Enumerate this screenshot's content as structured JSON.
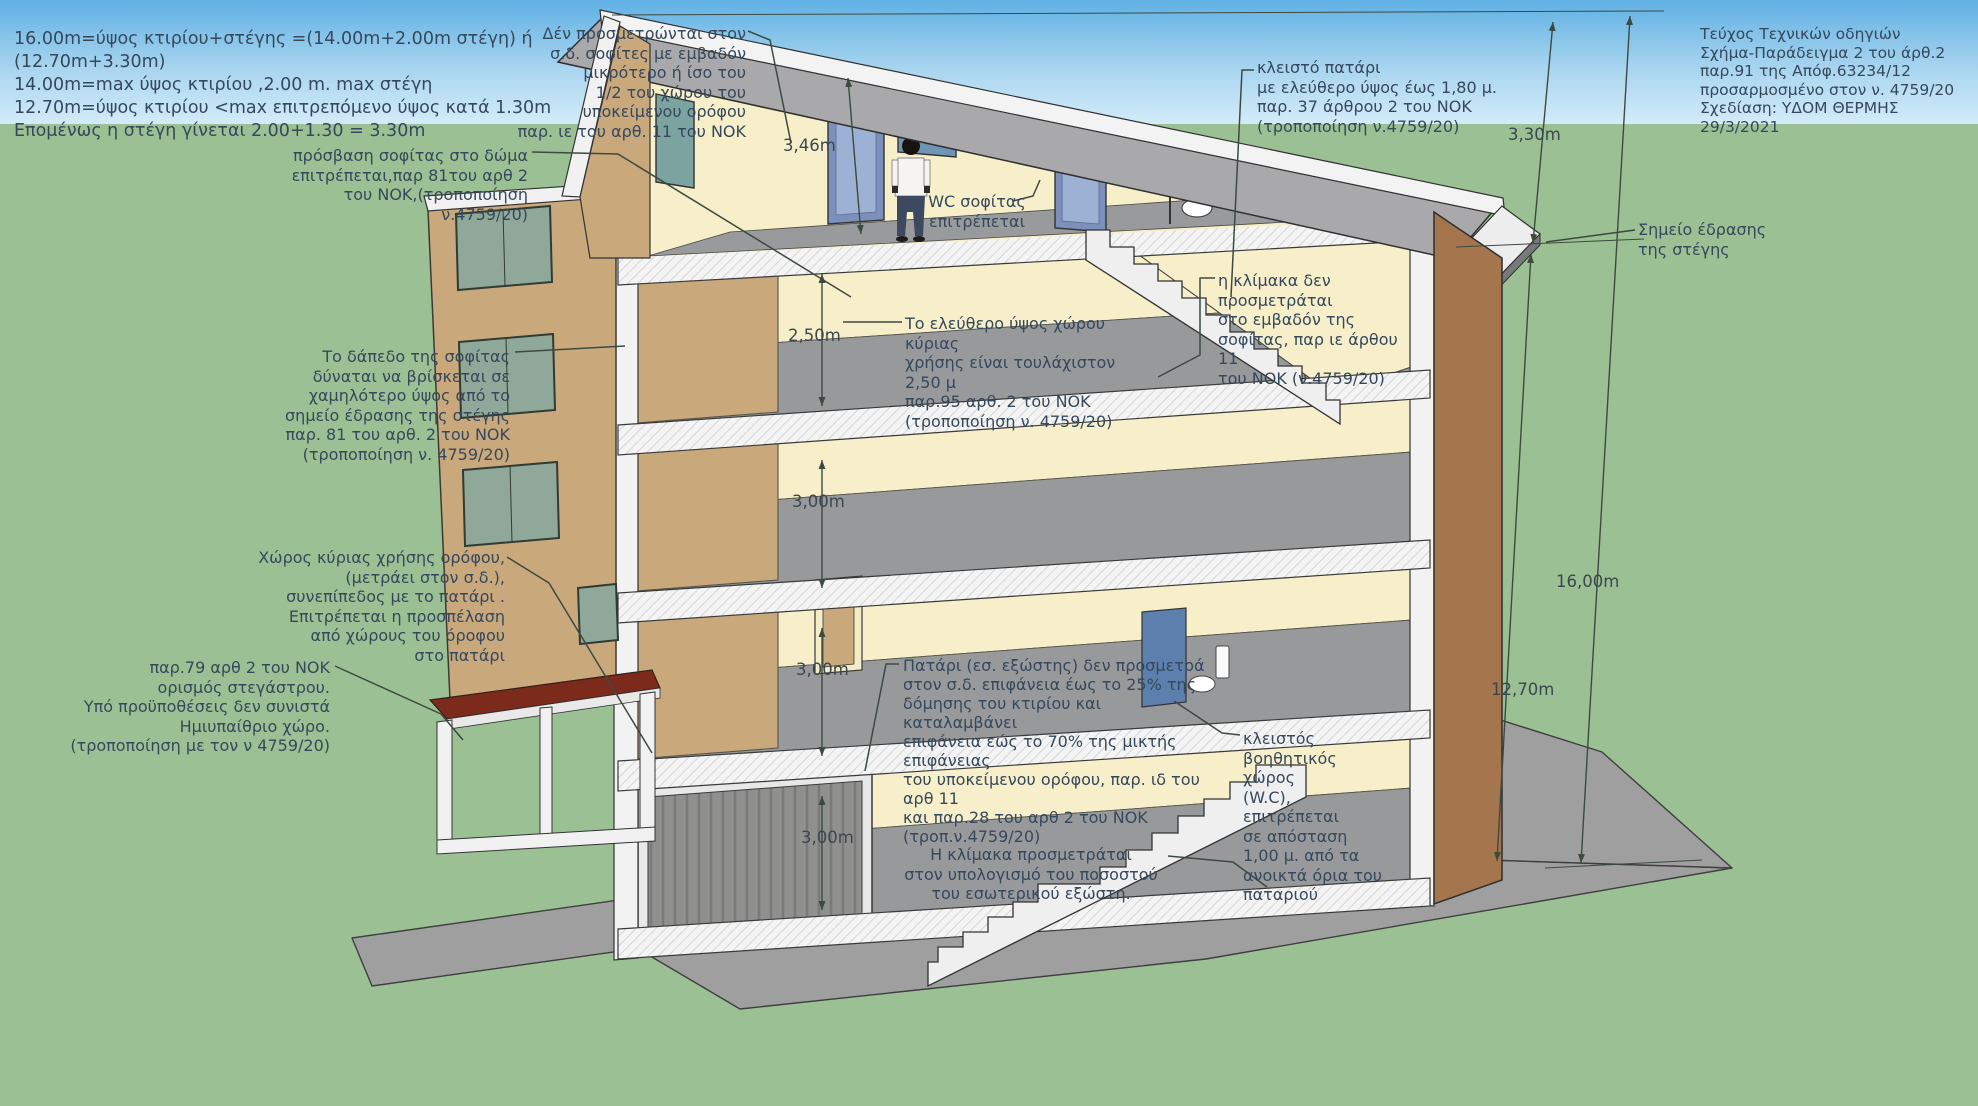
{
  "legend": {
    "text": "16.00m=ύψος κτιρίου+στέγης =(14.00m+2.00m στέγη) ή (12.70m+3.30m)\n14.00m=max ύψος κτιρίου ,2.00 m. max στέγη\n12.70m=ύψος κτιρίου <max επιτρεπόμενο ύψος κατά 1.30m\nΕπομένως η στέγη γίνεται 2.00+1.30 = 3.30m"
  },
  "title_block": {
    "text": "Τεύχος Τεχνικών οδηγιών\nΣχήμα-Παράδειγμα 2 του άρθ.2\nπαρ.91 της Απόφ.63234/12\nπροσαρμοσμένο στον ν. 4759/20\nΣχεδίαση: ΥΔΟΜ ΘΕΡΜΗΣ\n29/3/2021"
  },
  "annotations": {
    "attic_not_counted": {
      "text": "Δέν προσμετρώνται στον\nσ.δ. σοφίτες με εμβαδόν\nμικρότερο ή ίσο του\n1/2 του χώρου του\nυποκείμενου ορόφου\nπαρ. ιε του αρθ. 11 του ΝΟΚ"
    },
    "closed_loft": {
      "text": "κλειστό πατάρι\nμε ελεύθερο ύψος έως 1,80 μ.\nπαρ. 37 άρθρου 2 του ΝΟΚ\n(τροποποίηση ν.4759/20)"
    },
    "attic_access": {
      "text": "πρόσβαση σοφίτας στο δώμα\nεπιτρέπεται,παρ 81του αρθ 2\nτου ΝΟΚ,(τροποποίηση\nν.4759/20)"
    },
    "attic_floor_level": {
      "text": "Το δάπεδο της σοφίτας\nδύναται να βρίσκεται σε\nχαμηλότερο ύψος από το\nσημείο έδρασης της στέγης\nπαρ. 81 του αρθ. 2 του ΝΟΚ\n(τροποποίηση ν. 4759/20)"
    },
    "main_use_space": {
      "text": "Χώρος κύριας χρήσης ορόφου,\n(μετράει στον σ.δ.),\nσυνεπίπεδος με το πατάρι .\nΕπιτρέπεται η προσπέλαση\nαπό χώρους του όροφου\nστο πατάρι"
    },
    "canopy_definition": {
      "text": "παρ.79 αρθ 2 του ΝΟΚ\nορισμός στεγάστρου.\nΥπό προϋποθέσεις δεν συνιστά\nΗμιυπαίθριο χώρο.\n(τροποποίηση με τον ν 4759/20)"
    },
    "wc_attic": {
      "text": "WC σοφίτας\nεπιτρέπεται"
    },
    "clear_height": {
      "text": "Το ελεύθερο ύψος χώρου κύριας\nχρήσης είναι τουλάχιστον 2,50 μ\nπαρ.95 αρθ. 2 του ΝΟΚ\n(τροποποίηση ν. 4759/20)"
    },
    "attic_stair": {
      "text": "η κλίμακα δεν\nπροσμετράται\nστο εμβαδόν της\nσοφίτας, παρ ιε άρθου 11\nτου ΝΟΚ (ν.4759/20)"
    },
    "roof_bearing_point": {
      "text": "Σημείο έδρασης\nτης στέγης"
    },
    "loft_mezzanine": {
      "text": "Πατάρι (εσ. εξώστης) δεν προσμετρά\nστον σ.δ. επιφάνεια  έως το 25% της\nδόμησης του κτιρίου και καταλαμβάνει\nεπιφάνεια εώς το 70% της μικτής επιφάνειας\nτου υποκείμενου ορόφου, παρ. ιδ του αρθ 11\nκαι παρ.28 του αρθ 2 του ΝΟΚ\n(τροπ.ν.4759/20)"
    },
    "wc_closed_space": {
      "text": "κλειστός\nβοηθητικός χώρος\n(W.C), επιτρέπεται\nσε απόσταση\n1,00 μ. από τα\nανοικτά όρια του\nπαταριού"
    },
    "stair_counted": {
      "text": "Η κλίμακα προσμετράται\nστον υπολογισμό του ποσοστού\nτου εσωτερικού εξώστη."
    }
  },
  "dimensions": {
    "attic_interior": "3,46m",
    "top_floor_clear": "2,50m",
    "floor_2": "3,00m",
    "floor_1": "3,00m",
    "ground_floor": "3,00m",
    "roof_height": "3,30m",
    "total_height": "16,00m",
    "building_height": "12,70m"
  },
  "colors": {
    "sky_top": "#5fb0e4",
    "sky_bottom": "#d4ecf9",
    "grass": "#9bc093",
    "concrete": "#9f9f9f",
    "roof_gray": "#a9a9ab",
    "cut_wall_tan": "#c9a87c",
    "exterior_wall_brown": "#a5764e",
    "interior_yellow": "#f6efc9",
    "slab_white": "#f4f4f4",
    "canopy_red": "#7c2a1c",
    "door_blue": "#7b91bb",
    "window_green": "#8fa899",
    "annotation_text": "#35485c",
    "line": "#3c4a40"
  }
}
